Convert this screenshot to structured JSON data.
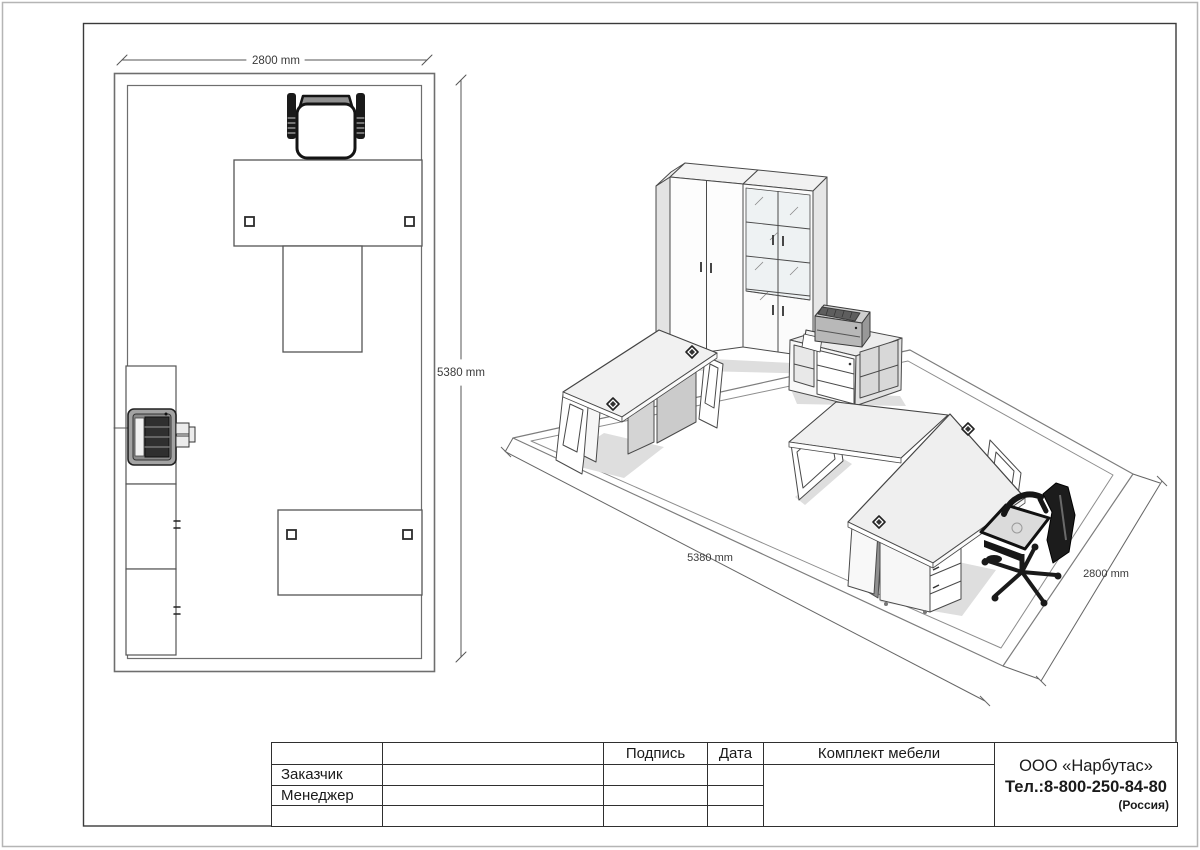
{
  "floor_plan": {
    "width_dim": "2800 mm",
    "length_dim": "5380 mm"
  },
  "iso_view": {
    "length_dim": "5380 mm",
    "width_dim": "2800 mm"
  },
  "title_block": {
    "headers": {
      "signature": "Подпись",
      "date": "Дата"
    },
    "rows": [
      {
        "label": "Заказчик"
      },
      {
        "label": "Менеджер"
      }
    ],
    "project_title": "Комплект мебели",
    "company": {
      "name": "ООО «Нарбутас»",
      "phone": "Тел.:8-800-250-84-80",
      "country": "(Россия)"
    }
  },
  "colors": {
    "line": "#4a4a4a",
    "wall": "#6e6e6e",
    "dim_text": "#3a3a3a",
    "chair_black": "#1a1a1a",
    "panel_gray": "#d0d0d0",
    "printer_gray": "#a3a3a3"
  }
}
